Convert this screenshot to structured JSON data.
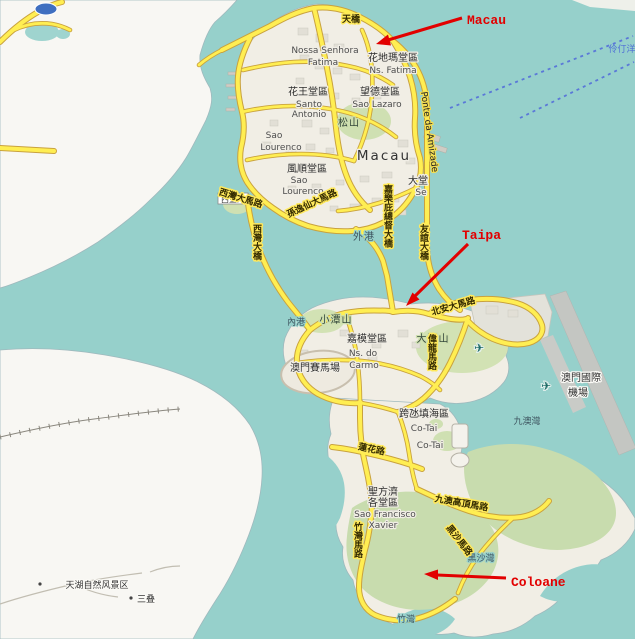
{
  "map": {
    "annotations": {
      "macau": "Macau",
      "taipa": "Taipa",
      "coloane": "Coloane"
    },
    "places": {
      "nossa_senhora": "Nossa Senhora",
      "fatima_pt": "Fatima",
      "fatima_zh": "花地瑪堂區",
      "ns_fatima": "Ns. Fatima",
      "fa_wong": "花王堂區",
      "santo": "Santo",
      "antonio": "Antonio",
      "mong_tak": "望德堂區",
      "sao_lazaro": "Sao Lazaro",
      "song_shan": "松山",
      "sao1": "Sao",
      "lourenco1": "Lourenco",
      "macau_city": "Macau",
      "fung_shun": "風順堂區",
      "sao2": "Sao",
      "lourenco2": "Lourenco",
      "tai_tong": "大堂",
      "se": "Se",
      "sai_mong_yeung": "西望洋",
      "outer_harbour": "外港",
      "inner_harbour": "內港",
      "siu_tam_shan": "小潭山",
      "carmo_zh": "嘉模堂區",
      "carmo_pt1": "Ns. do",
      "carmo_pt2": "Carmo",
      "tai_tam_shan": "大潭山",
      "racecourse": "澳門賽馬場",
      "cotai_zh": "跨氹填海區",
      "cotai1": "Co-Tai",
      "cotai2": "Co-Tai",
      "xavier_zh1": "聖方濟",
      "xavier_zh2": "各堂區",
      "xavier_pt1": "Sao Francisco",
      "xavier_pt2": "Xavier",
      "hac_sa": "黑沙灣",
      "cheoc_van": "竹灣",
      "ka_ho": "九澳灣",
      "airport1": "澳門國際",
      "airport2": "機場",
      "tianhu": "天湖自然风景区",
      "sandie": "三叠",
      "lingding": "伶仃洋"
    },
    "roads": {
      "footbridge": "天橋",
      "sun_yat_sen": "孫逸仙大馬路",
      "sai_van_rd": "西灣大馬路",
      "sai_van_bridge": "西灣大橋",
      "nobre_carvalho": "嘉樂庇總督大橋",
      "ponte_amizade_pt": "Ponte da Amizade",
      "ponte_amizade_zh": "友誼大橋",
      "pak_on": "北安大馬路",
      "wai_long": "偉龍馬路",
      "lotus": "蓮花路",
      "ka_ho_alto": "九澳高頂馬路",
      "hac_sa_rd": "黑沙馬路",
      "cheoc_van_rd": "竹灣馬路"
    },
    "icons": {
      "airplane": "✈"
    }
  }
}
